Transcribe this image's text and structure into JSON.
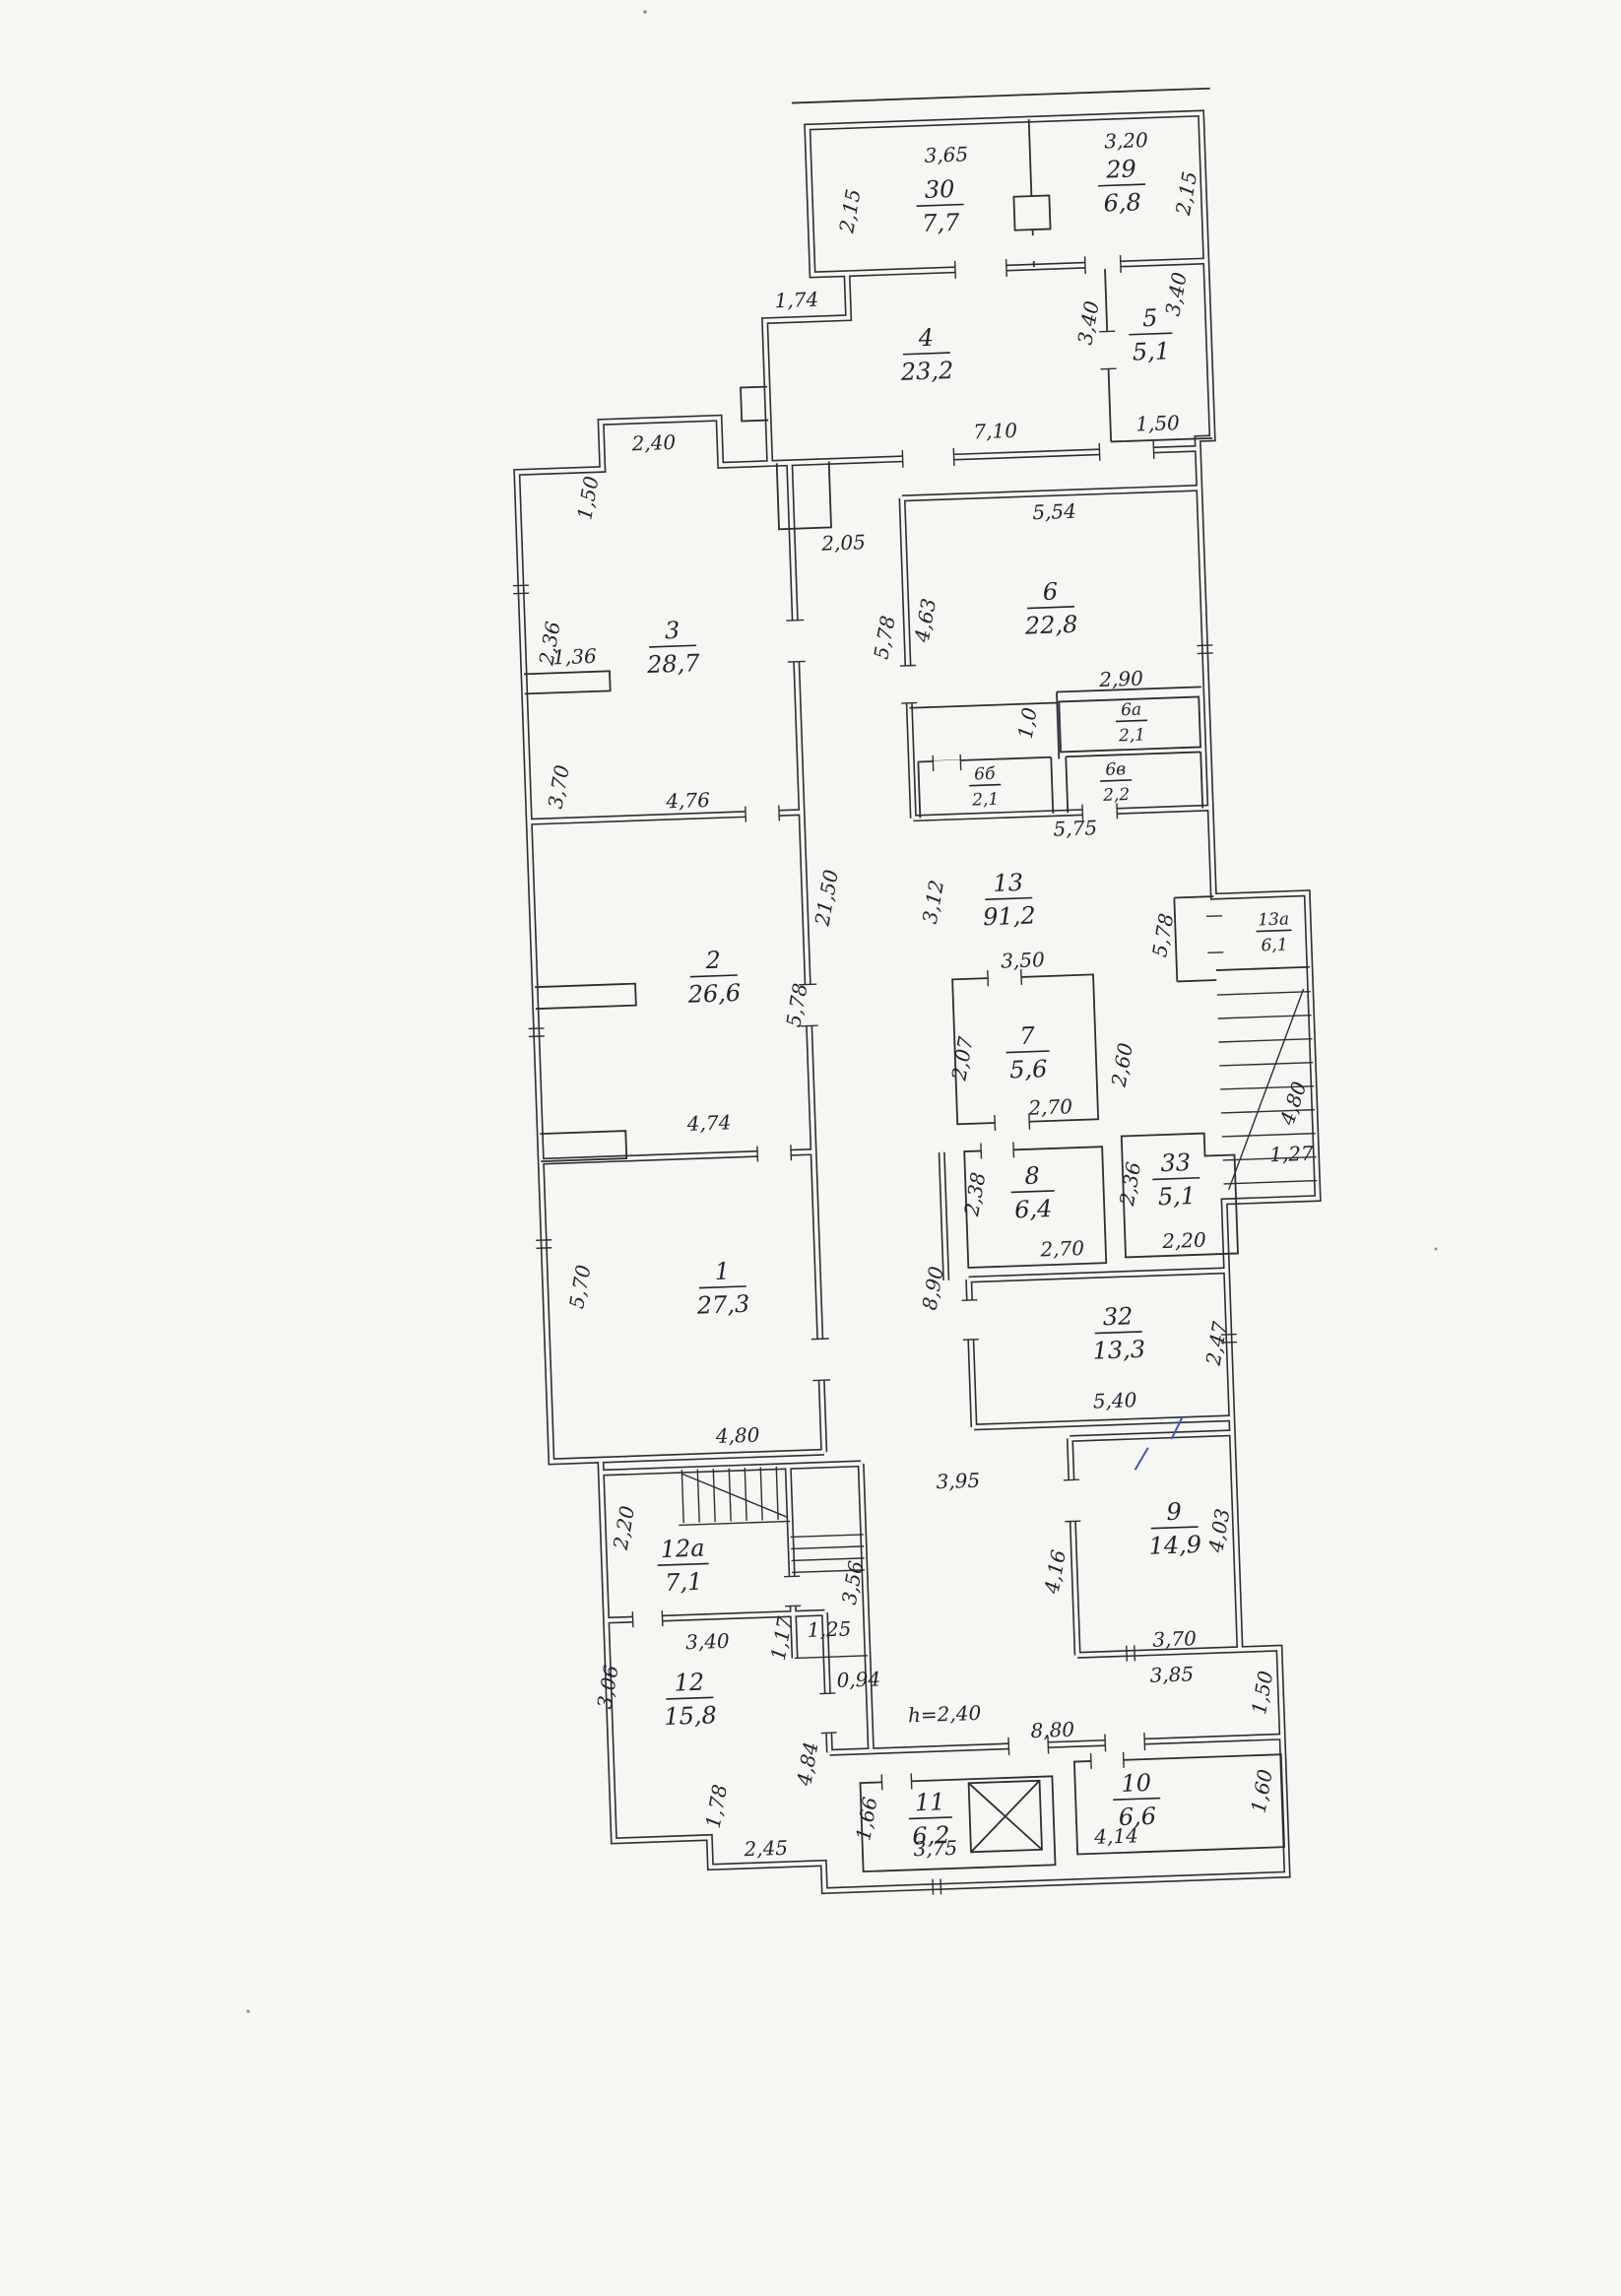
{
  "document": {
    "kind": "scanned floor plan"
  },
  "rooms": {
    "r1": {
      "num": "1",
      "area": "27,3"
    },
    "r2": {
      "num": "2",
      "area": "26,6"
    },
    "r3": {
      "num": "3",
      "area": "28,7"
    },
    "r4": {
      "num": "4",
      "area": "23,2"
    },
    "r5": {
      "num": "5",
      "area": "5,1"
    },
    "r6": {
      "num": "6",
      "area": "22,8"
    },
    "r6a": {
      "num": "6а",
      "area": "2,1"
    },
    "r6b": {
      "num": "6б",
      "area": "2,1"
    },
    "r6v": {
      "num": "6в",
      "area": "2,2"
    },
    "r7": {
      "num": "7",
      "area": "5,6"
    },
    "r8": {
      "num": "8",
      "area": "6,4"
    },
    "r9": {
      "num": "9",
      "area": "14,9"
    },
    "r10": {
      "num": "10",
      "area": "6,6"
    },
    "r11": {
      "num": "11",
      "area": "6,2"
    },
    "r12": {
      "num": "12",
      "area": "15,8"
    },
    "r12a": {
      "num": "12а",
      "area": "7,1"
    },
    "r13": {
      "num": "13",
      "area": "91,2"
    },
    "r13a": {
      "num": "13а",
      "area": "6,1"
    },
    "r29": {
      "num": "29",
      "area": "6,8"
    },
    "r30": {
      "num": "30",
      "area": "7,7"
    },
    "r32": {
      "num": "32",
      "area": "13,3"
    },
    "r33": {
      "num": "33",
      "area": "5,1"
    }
  },
  "dims": {
    "t30_w": "3,65",
    "t30_h": "2,15",
    "t29_w": "3,20",
    "t29_h": "2,15",
    "r4_nw": "1,74",
    "r4_s": "7,10",
    "r4_e": "3,40",
    "r5_e": "3,40",
    "r5_s": "1,50",
    "corr_n": "2,05",
    "r3_bump": "2,40",
    "r3_notch": "1,50",
    "r3_w1": "2,36",
    "r3_pier": "1,36",
    "r3_w2": "3,70",
    "r3_s": "4,76",
    "r6_n": "5,54",
    "r6_w": "4,63",
    "r6_wo": "5,78",
    "r6a_n": "2,90",
    "r6_d": "1,0",
    "r6_s": "5,75",
    "r2_e1": "21,50",
    "r2_e2": "5,78",
    "r2_s": "4,74",
    "c13_v": "3,12",
    "r7_n": "3,50",
    "r7_w": "2,07",
    "r7_s": "2,70",
    "r7_e": "2,60",
    "st_w": "5,78",
    "st_diag": "4,80",
    "st_s": "1,27",
    "r8_w": "2,38",
    "r8_s": "2,70",
    "r33_w": "2,36",
    "r33_s": "2,20",
    "c_890": "8,90",
    "r32_s": "5,40",
    "r32_e": "2,47",
    "r1_w": "5,70",
    "r1_s": "4,80",
    "c_395": "3,95",
    "r9_w": "4,16",
    "r9_e": "4,03",
    "r9_s": "3,70",
    "r9_s2": "3,85",
    "r9_step": "1,50",
    "r12a_w": "2,20",
    "h_356": "3,56",
    "h_125": "1,25",
    "h_117": "1,17",
    "h_094": "0,94",
    "r12_n": "3,40",
    "r12_w": "3,06",
    "r12_sv": "1,78",
    "r12_s": "2,45",
    "c_484": "4,84",
    "b_880": "8,80",
    "height_note": "h=2,40",
    "r11_w": "1,66",
    "r11_s": "3,75",
    "r10_s": "4,14",
    "r10_e": "1,60"
  }
}
